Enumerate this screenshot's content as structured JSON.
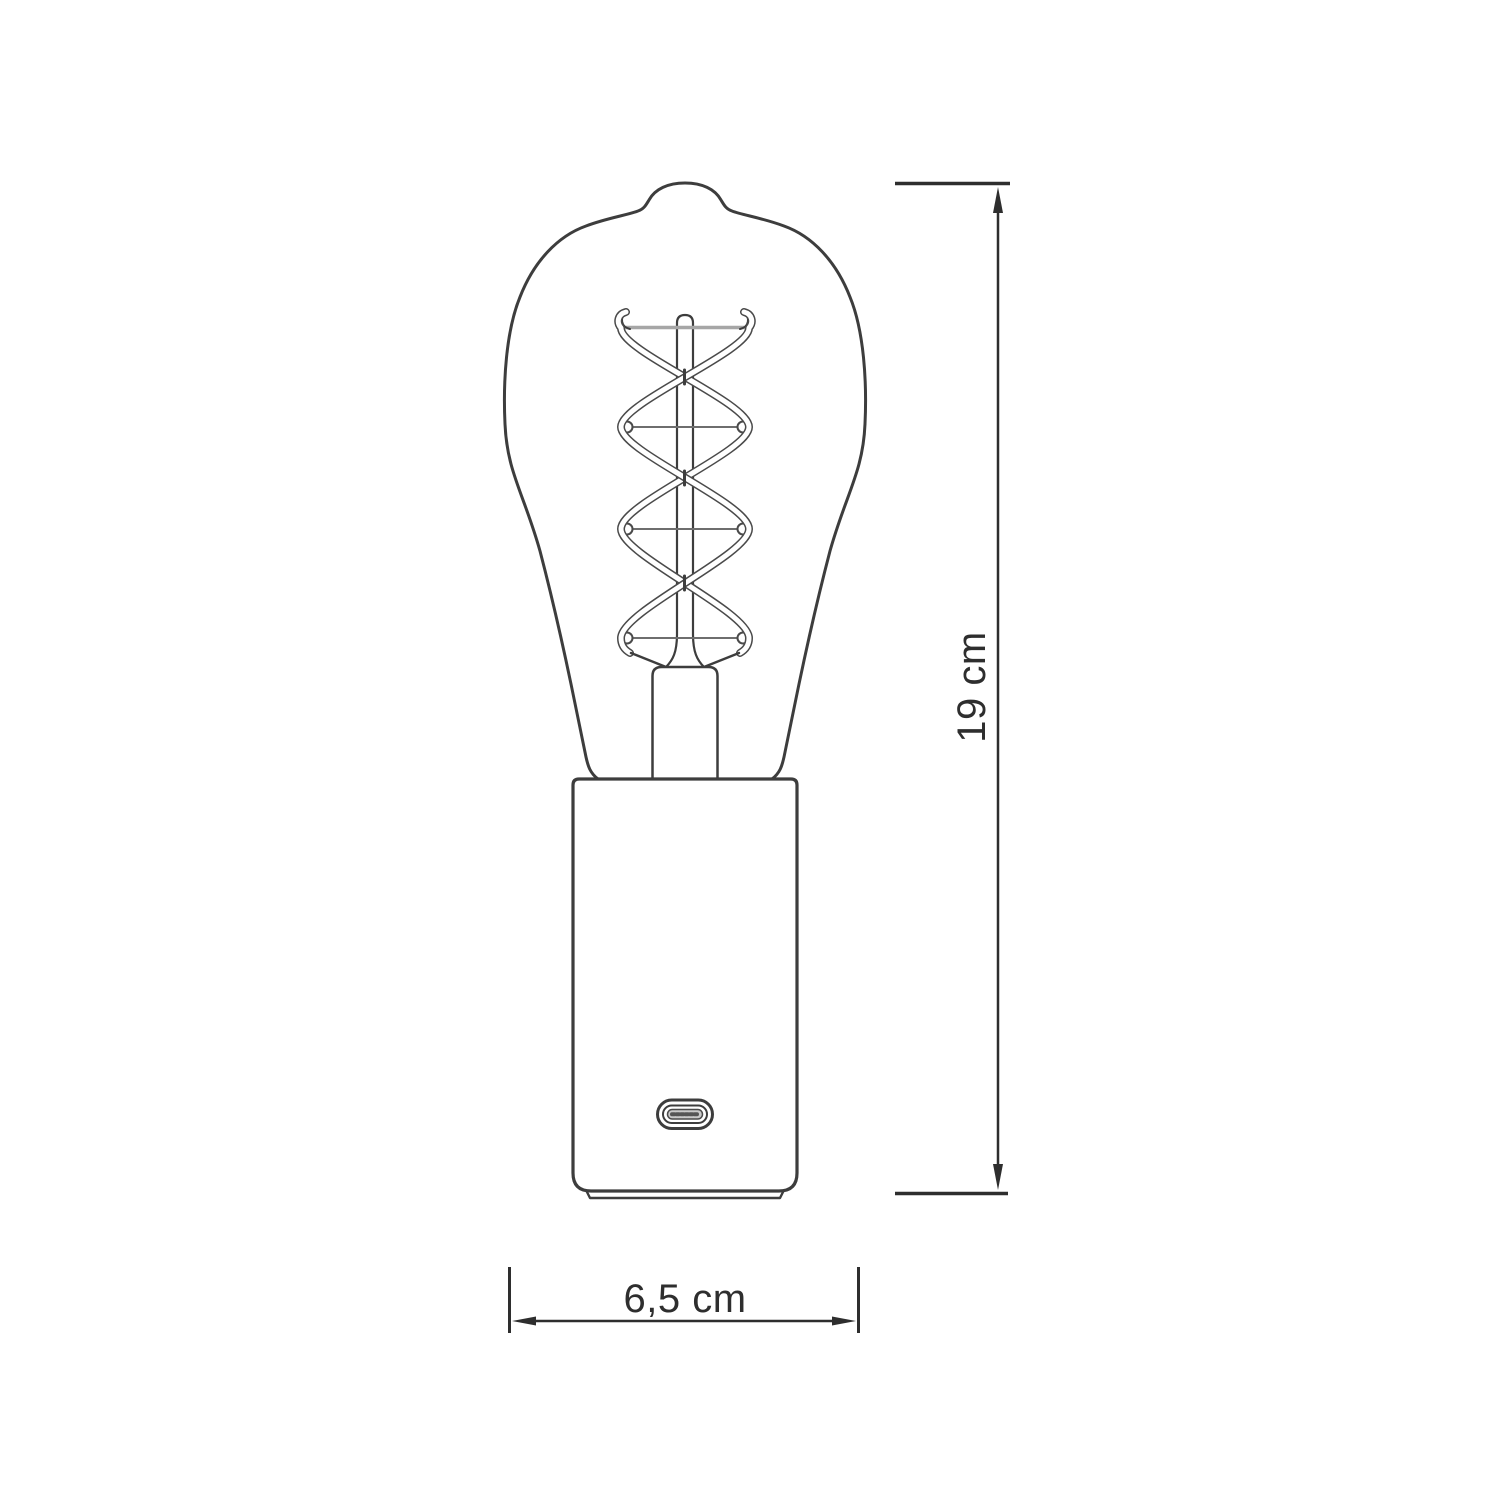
{
  "diagram": {
    "type": "technical-dimension-drawing",
    "subject": "portable table lamp with ST64 Edison spiral-filament bulb, cylindrical base and USB-C charging port",
    "dimensions": {
      "height": {
        "label": "19 cm",
        "orientation": "vertical",
        "side": "right"
      },
      "width": {
        "label": "6,5 cm",
        "orientation": "horizontal",
        "side": "bottom"
      }
    },
    "colors": {
      "background": "#ffffff",
      "outline": "#3d3d3d",
      "dimension_line": "#2e2e2e",
      "support_wire_gray": "#a6a6a6",
      "port_slot_fill": "#c9c9c9"
    },
    "parts": [
      "edison-bulb-st64-outline",
      "glass-stem",
      "double-spiral-filament",
      "filament-support-bars",
      "stem-press-socket",
      "cylindrical-base",
      "base-foot",
      "usb-c-port"
    ]
  }
}
